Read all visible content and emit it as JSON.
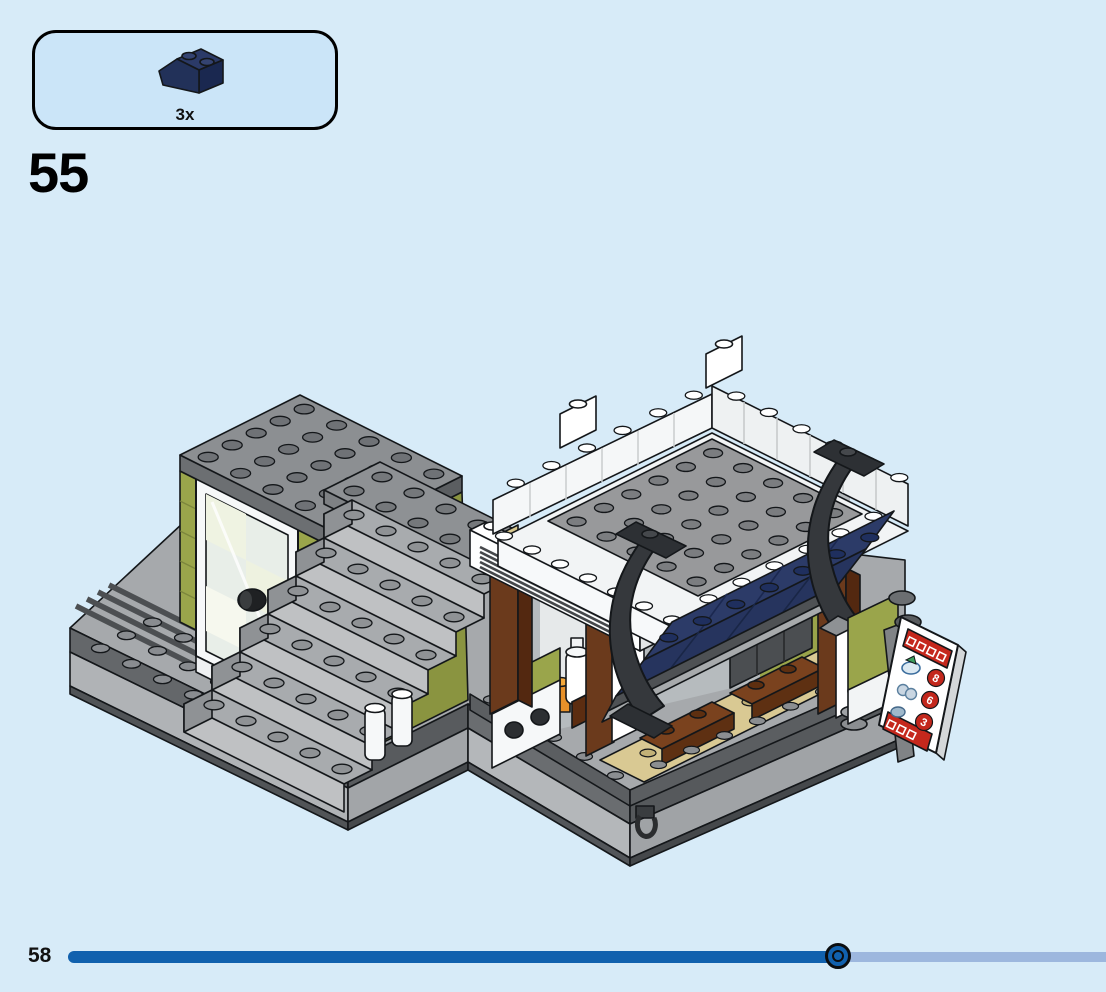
{
  "page": {
    "background_color": "#d7ebf8",
    "step_number": "55",
    "page_number": "58"
  },
  "parts_callout": {
    "quantity_label": "3x",
    "part_name": "slope-brick-2x2-45deg-dark-blue",
    "part_color": "#223159",
    "box_fill": "#cbe5f8"
  },
  "progress_bar": {
    "completed_fraction": 0.74,
    "fill_color": "#1161ae",
    "track_color": "#9db7de",
    "marker_style": "black-outlined-ring-circle"
  },
  "illustration": {
    "caption": "Isometric build view for step 55: corner modular building with a grey staircase tower (olive-green walls, white glass door), grey baseplate with rails, and a market stall with grey studded roof, white parapets, dark-blue sloped awning, black curved roof brackets, reddish-brown posts and counter with white bowls, tan floor with brown crates, and a red-and-white menu sign",
    "menu_sign_prices": [
      "8",
      "6",
      "3"
    ],
    "colors": {
      "olive_green": "#9aa54b",
      "awning_navy": "#26345e",
      "reddish_brown": "#6b3a1c",
      "tan": "#d9c993",
      "light_grey": "#b0b3b5",
      "dark_grey": "#8c8f92",
      "charcoal": "#35383c",
      "white": "#ffffff",
      "accent_red": "#c3271c"
    }
  }
}
